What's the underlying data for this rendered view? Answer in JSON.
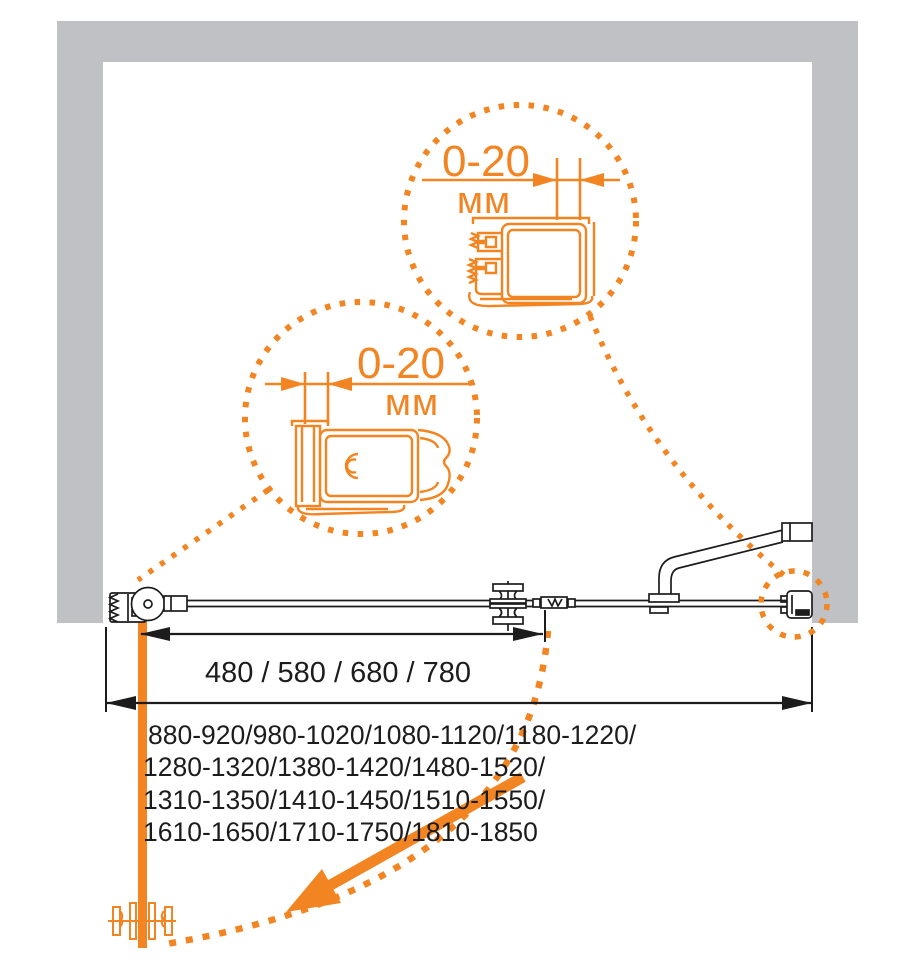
{
  "colors": {
    "accent": "#F28522",
    "wall_gray": "#BFC1C4",
    "line_black": "#1c1c1c",
    "background": "#ffffff"
  },
  "detail_top": {
    "value": "0-20",
    "unit": "мм"
  },
  "detail_left": {
    "value": "0-20",
    "unit": "мм"
  },
  "dimensions": {
    "door_width_label": "480 / 580 / 680 / 780",
    "overall_width_lines": [
      "880-920/980-1020/1080-1120/1180-1220/",
      "1280-1320/1380-1420/1480-1520/",
      "1310-1350/1410-1450/1510-1550/",
      "1610-1650/1710-1750/1810-1850"
    ]
  },
  "icons": [
    "wall-profile-left-icon",
    "hinge-icon",
    "knob-icon",
    "magnet-joint-icon",
    "support-bar-icon",
    "wall-profile-right-icon",
    "knob-open-icon",
    "profile-section-top-icon",
    "profile-section-left-icon",
    "door-swing-arrow-icon"
  ]
}
